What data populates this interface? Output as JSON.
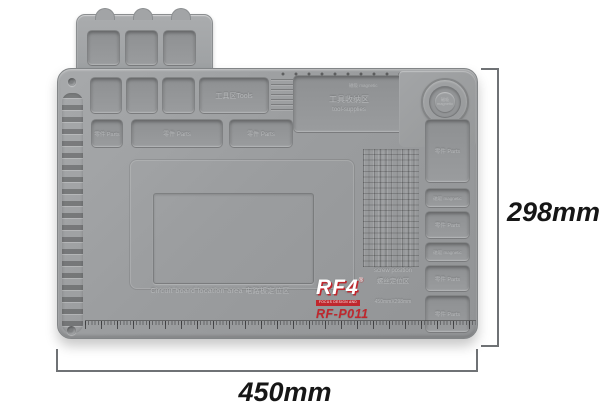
{
  "annotations": {
    "height_label": "298mm",
    "width_label": "450mm"
  },
  "branding": {
    "logo": "RF4",
    "registered_mark": "®",
    "tagline": "FOCUS DESIGN AND CONCEPT",
    "model": "RF-P011",
    "accent_red": "#c0272d"
  },
  "mat": {
    "base_color": "#9a9c9e",
    "labels": {
      "tools_area": "工具区Tools",
      "tool_supplies_cn": "工具收纳区",
      "tool_supplies_en": "tool-supplies",
      "parts": "零件 Parts",
      "magnetic_full": "磁吸 magnetic",
      "magnetic_cn": "磁吸",
      "magnetic_en": "magnetic",
      "screw_position_en": "screw position",
      "screw_position_cn": "螺丝定位区",
      "size_note": "450mmX298mm",
      "circuit_board": "Circuit board location area  电路板定位区"
    },
    "parts_row": [
      {
        "label": "零件 Parts"
      },
      {
        "label": "零件 Parts"
      },
      {
        "label": "零件 Parts"
      }
    ],
    "right_column": [
      {
        "type": "parts",
        "label": "零件 Parts"
      },
      {
        "type": "magnetic",
        "label": "磁吸 magnetic"
      },
      {
        "type": "parts",
        "label": "零件 Parts"
      },
      {
        "type": "magnetic",
        "label": "磁吸 magnetic"
      },
      {
        "type": "parts",
        "label": "零件 Parts"
      },
      {
        "type": "parts",
        "label": "零件 Parts"
      }
    ]
  }
}
